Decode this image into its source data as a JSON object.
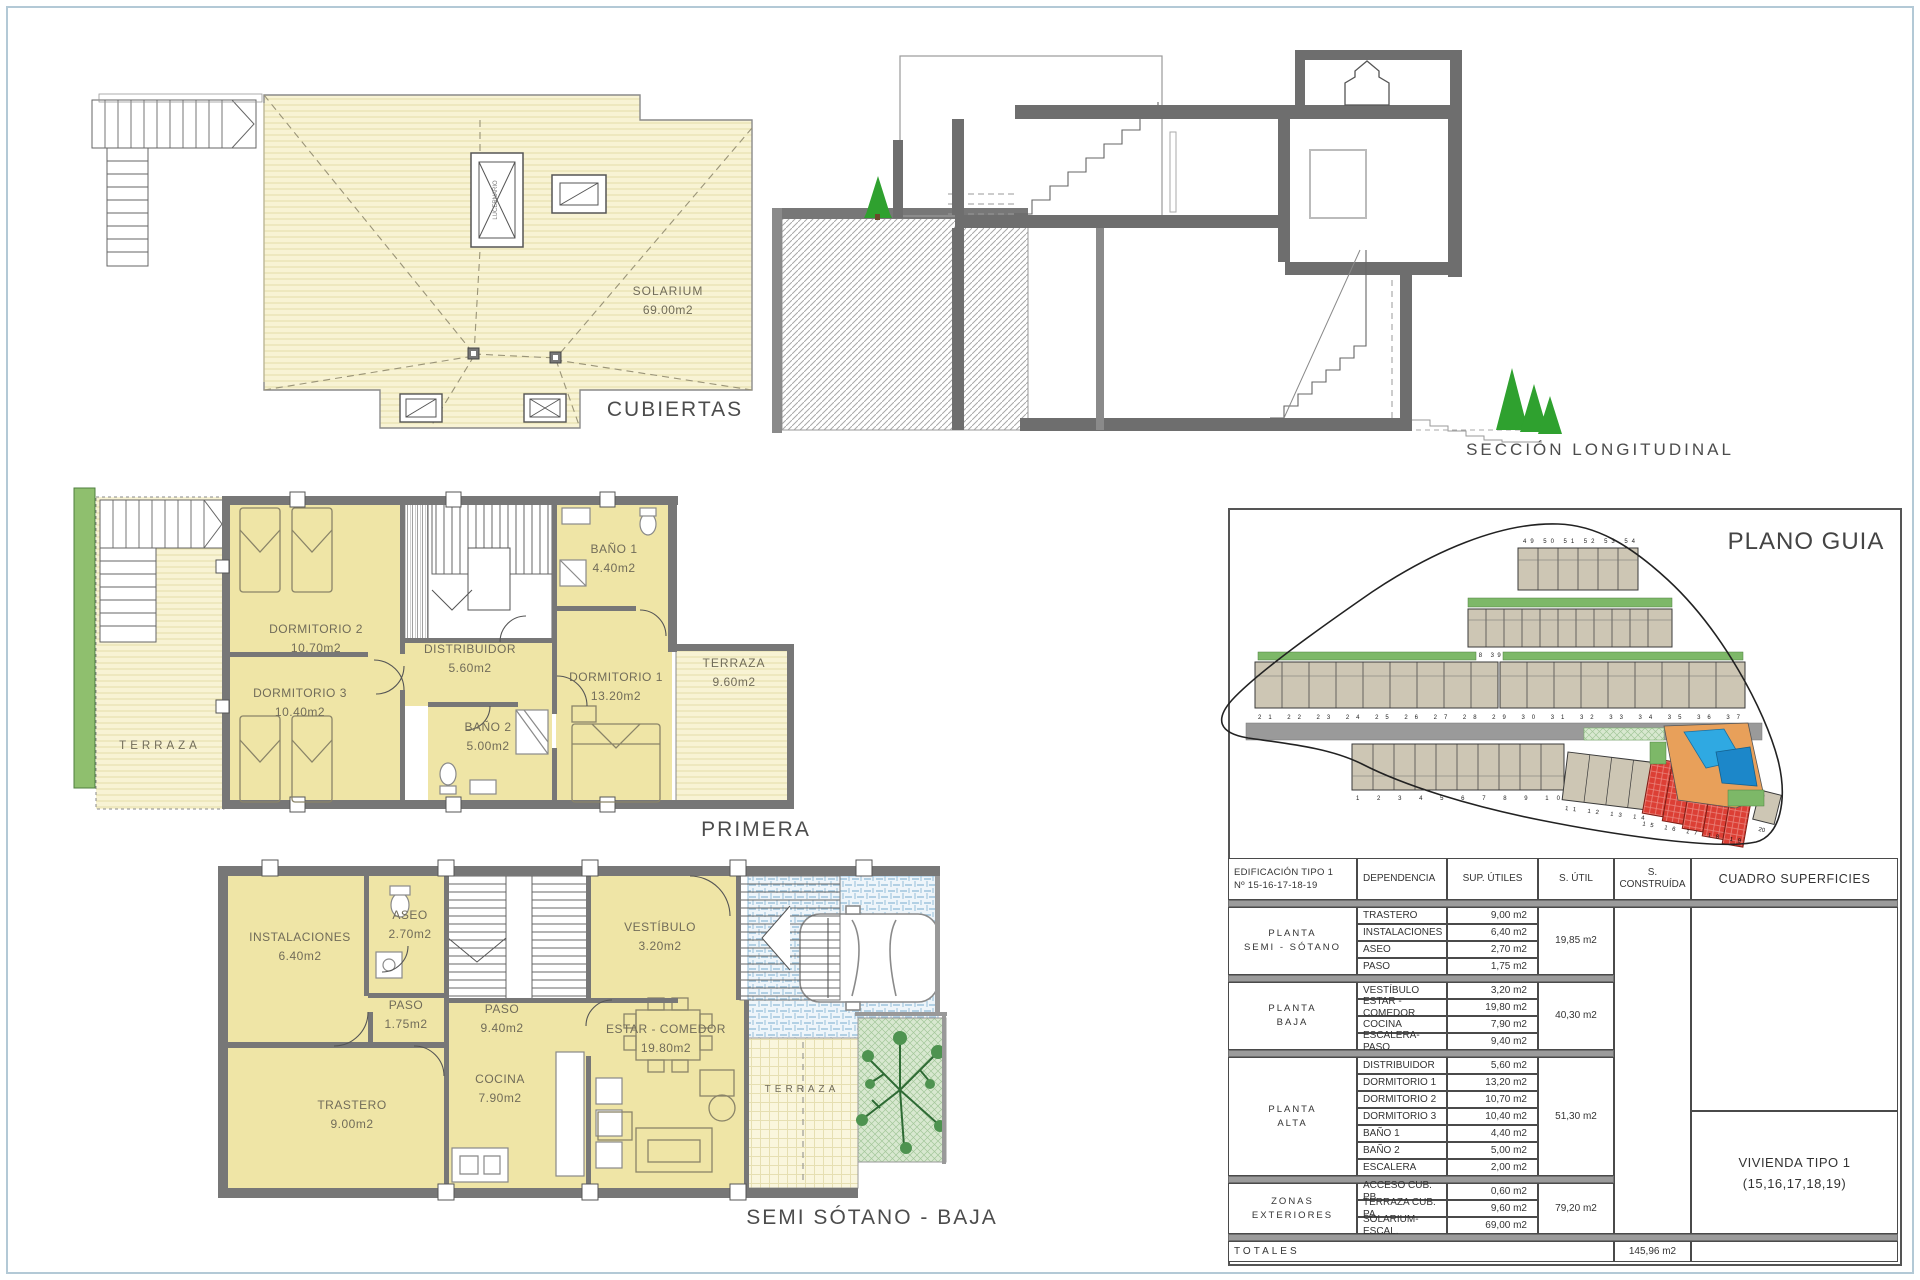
{
  "titles": {
    "cubiertas": "CUBIERTAS",
    "seccion": "SECCIÓN  LONGITUDINAL",
    "primera": "PRIMERA",
    "semisotano": "SEMI SÓTANO - BAJA",
    "plano_guia": "PLANO GUIA"
  },
  "cubiertas": {
    "solarium_name": "SOLARIUM",
    "solarium_area": "69.00m2",
    "skylight_label": "LUCERNARIO"
  },
  "primera": {
    "terraza_left": "TERRAZA",
    "dorm2": {
      "name": "DORMITORIO 2",
      "area": "10.70m2"
    },
    "dorm3": {
      "name": "DORMITORIO 3",
      "area": "10.40m2"
    },
    "distribuidor": {
      "name": "DISTRIBUIDOR",
      "area": "5.60m2"
    },
    "bano1": {
      "name": "BAÑO 1",
      "area": "4.40m2"
    },
    "bano2": {
      "name": "BAÑO 2",
      "area": "5.00m2"
    },
    "dorm1": {
      "name": "DORMITORIO 1",
      "area": "13.20m2"
    },
    "terraza_right": {
      "name": "TERRAZA",
      "area": "9.60m2"
    }
  },
  "semisotano": {
    "instalaciones": {
      "name": "INSTALACIONES",
      "area": "6.40m2"
    },
    "aseo": {
      "name": "ASEO",
      "area": "2.70m2"
    },
    "paso1": {
      "name": "PASO",
      "area": "1.75m2"
    },
    "paso2": {
      "name": "PASO",
      "area": "9.40m2"
    },
    "vestibulo": {
      "name": "VESTÍBULO",
      "area": "3.20m2"
    },
    "estar": {
      "name": "ESTAR - COMEDOR",
      "area": "19.80m2"
    },
    "cocina": {
      "name": "COCINA",
      "area": "7.90m2"
    },
    "trastero": {
      "name": "TRASTERO",
      "area": "9.00m2"
    },
    "terraza": "TERRAZA"
  },
  "site": {
    "row_a_numbers": "49 50 51 52 53 54",
    "row_b_numbers": "38 39 40 41 42 43 44 45 46 47 48",
    "row_c_numbers": "21 22 23 24 25 26 27 28 29 30 31 32 33 34 35 36 37",
    "row_d_numbers": "1 2 3 4 5 6 7 8 9 10",
    "row_e_numbers": "11 12 13 14",
    "highlight_numbers": "15 16 17 18 19",
    "unit20": "20",
    "colors": {
      "highlight": "#dc3f35",
      "pool": "#2fa9e2",
      "deck": "#e8a05a",
      "unit": "#cdc6b4",
      "green": "#7db868"
    }
  },
  "table": {
    "headers": {
      "edificio_line1": "EDIFICACIÓN TIPO 1",
      "edificio_line2": "Nº 15-16-17-18-19",
      "dependencia": "DEPENDENCIA",
      "sup_utiles": "SUP. ÚTILES",
      "s_util": "S. ÚTIL",
      "s_construida": "S. CONSTRUÍDA",
      "cuadro": "CUADRO SUPERFICIES"
    },
    "groups": [
      {
        "l1": "PLANTA",
        "l2": "SEMI - SÓTANO",
        "util": "19,85 m2",
        "rows": [
          [
            "TRASTERO",
            "9,00 m2"
          ],
          [
            "INSTALACIONES",
            "6,40 m2"
          ],
          [
            "ASEO",
            "2,70 m2"
          ],
          [
            "PASO",
            "1,75 m2"
          ]
        ]
      },
      {
        "l1": "PLANTA",
        "l2": "BAJA",
        "util": "40,30 m2",
        "rows": [
          [
            "VESTÍBULO",
            "3,20 m2"
          ],
          [
            "ESTAR - COMEDOR",
            "19,80 m2"
          ],
          [
            "COCINA",
            "7,90 m2"
          ],
          [
            "ESCALERA-PASO",
            "9,40 m2"
          ]
        ]
      },
      {
        "l1": "PLANTA",
        "l2": "ALTA",
        "util": "51,30 m2",
        "rows": [
          [
            "DISTRIBUIDOR",
            "5,60 m2"
          ],
          [
            "DORMITORIO 1",
            "13,20 m2"
          ],
          [
            "DORMITORIO 2",
            "10,70 m2"
          ],
          [
            "DORMITORIO 3",
            "10,40 m2"
          ],
          [
            "BAÑO 1",
            "4,40 m2"
          ],
          [
            "BAÑO 2",
            "5,00 m2"
          ],
          [
            "ESCALERA",
            "2,00 m2"
          ]
        ]
      },
      {
        "l1": "ZONAS",
        "l2": "EXTERIORES",
        "util": "79,20 m2",
        "rows": [
          [
            "ACCESO CUB. PB",
            "0,60 m2"
          ],
          [
            "TERRAZA CUB. PA",
            "9,60 m2"
          ],
          [
            "SOLARIUM-ESCAL.",
            "69,00 m2"
          ]
        ]
      }
    ],
    "totales_label": "TOTALES",
    "total_construida": "145,96 m2",
    "vivienda_line1": "VIVIENDA TIPO 1",
    "vivienda_line2": "(15,16,17,18,19)"
  }
}
